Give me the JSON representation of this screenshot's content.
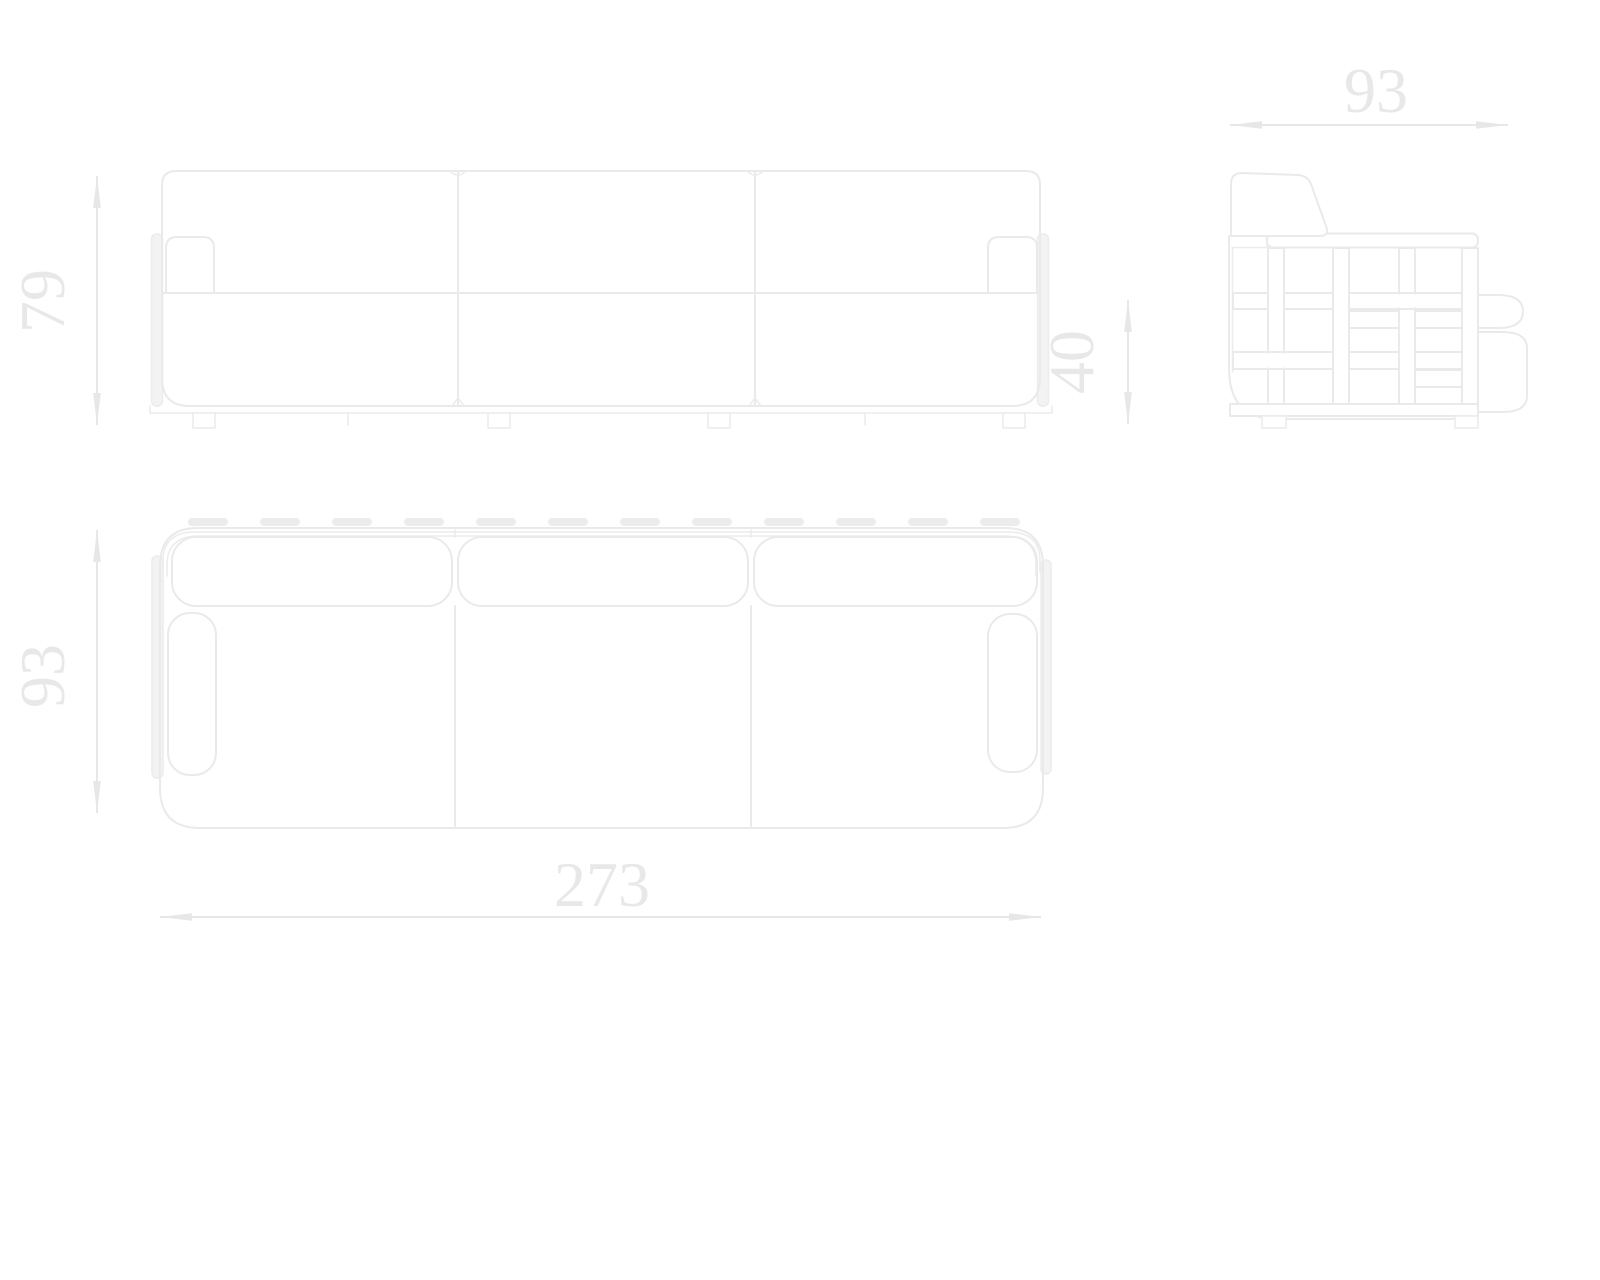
{
  "dimensions": {
    "front_height": "79",
    "plan_depth": "93",
    "overall_width": "273",
    "side_depth": "93",
    "seat_height": "40"
  },
  "palette": {
    "background": "#ffffff",
    "line": "#eaeaea",
    "line_soft": "#ececec",
    "strap_fill": "#f3f3f3",
    "pill_fill": "#ececec",
    "dimension_color": "#e8e8e8"
  }
}
